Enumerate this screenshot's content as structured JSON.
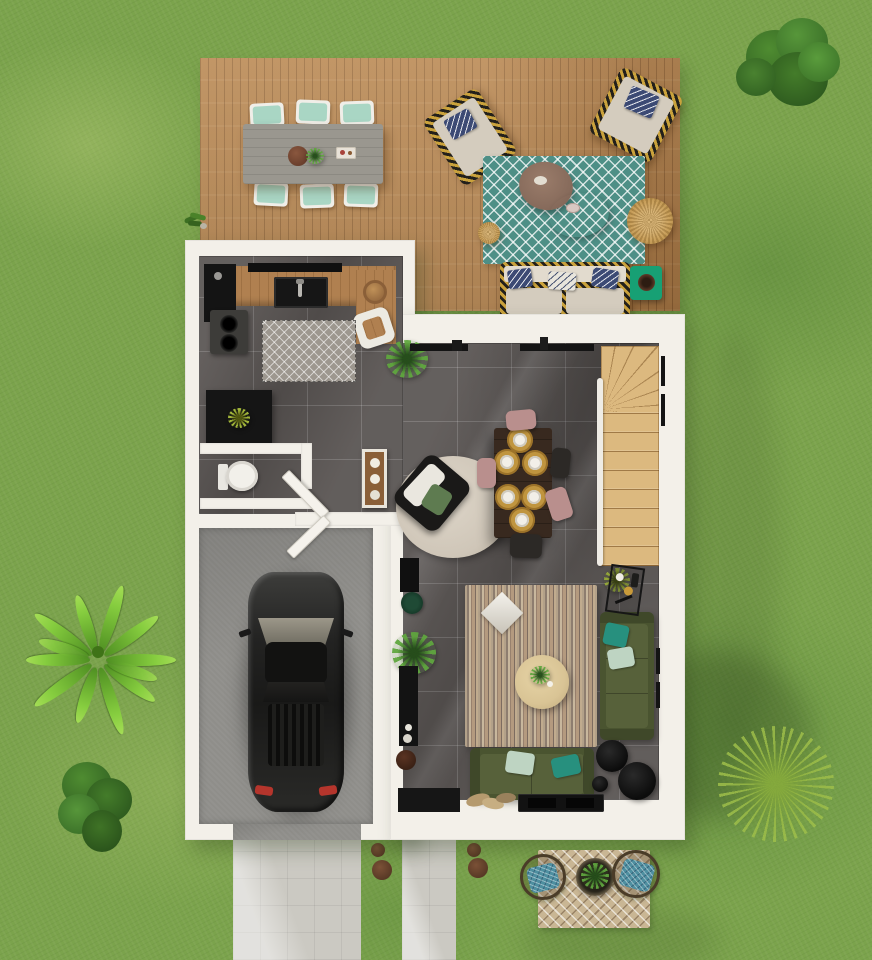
{
  "scene": {
    "description": "Top-down 3D architectural floor-plan render of a single-storey house with lawn, wooden terrace, garage, driveway and furnished interior",
    "view": "top-down",
    "canvas": {
      "width": 872,
      "height": 960
    }
  },
  "palette": {
    "grass": "#7ba34c",
    "deckWood": "#b5824c",
    "wall": "#f3f0e9",
    "tile": "#5c5755",
    "concrete": "#8f8e8a",
    "path": "#cbc9c2",
    "stairWood": "#dcb97f",
    "counterWood": "#b08050",
    "rugTeal": "#4e8f86",
    "sofaGreen": "#4a5430",
    "sofaGreenDark": "#57613a",
    "cushion": "#d4ccbe",
    "pillowNavy": "#3c4a74",
    "pillowMint": "#bed4c2",
    "pillowTeal": "#27907e",
    "outTableGray": "#9a978f",
    "seatMint": "#a9d6c4",
    "diningWood": "#38291f",
    "chairMauve": "#b98f8d",
    "chairDark": "#2c2926",
    "placemat": "#c0953f",
    "plate": "#f2efe8",
    "carBody": "#262624",
    "jute": "#c9a05c",
    "sideGreen": "#17a074",
    "rugRound": "#cfc6b8",
    "coffeeTable": "#d9c495",
    "bistroMat": "#c9b694",
    "bistroCushion": "#4e8fa0",
    "matGray": "#9d978f",
    "consoleWood": "#8a5f38",
    "stoneBrown": "#6b4630",
    "toilet": "#f2f0ea"
  },
  "outdoor": {
    "areas": [
      "lawn",
      "wooden-terrace",
      "driveway",
      "walkway"
    ],
    "terrace_items": [
      "outdoor-dining-table",
      "six-mint-chairs",
      "wicker-lounge-chair-west",
      "wicker-lounge-chair-north",
      "teal-chevron-rug",
      "two-coffee-tables",
      "jute-pouf-small",
      "jute-pouf-large",
      "outdoor-sofa",
      "green-side-table"
    ],
    "garden_items": [
      "palm-tree",
      "bush-top-right",
      "bush-bottom-left",
      "spiky-grass-plant",
      "bistro-set-with-planter",
      "stepping-stones",
      "grass-tuft"
    ]
  },
  "rooms": [
    {
      "id": "kitchen",
      "items": [
        "wood-counter",
        "sink",
        "cooktop",
        "black-cabinet",
        "coffee-machine",
        "kitchen-mat",
        "desk-chair",
        "round-stool",
        "plant-cabinet"
      ]
    },
    {
      "id": "wc",
      "items": [
        "toilet"
      ]
    },
    {
      "id": "entry-hall",
      "items": [
        "front-door",
        "console-table",
        "round-rug",
        "black-armchair"
      ]
    },
    {
      "id": "dining-area",
      "items": [
        "dining-table",
        "six-placemats",
        "five-chairs",
        "potted-palm"
      ]
    },
    {
      "id": "living-room",
      "items": [
        "striped-rug",
        "diamond-pillow",
        "round-coffee-table",
        "green-sofa-right",
        "green-sofa-bottom",
        "black-side-tables",
        "bar-cart",
        "tv-console",
        "media-units",
        "indoor-palm",
        "door-mat",
        "magazines"
      ]
    },
    {
      "id": "garage",
      "items": [
        "car",
        "garage-door"
      ]
    },
    {
      "id": "staircase",
      "items": [
        "winder-stairs",
        "railing",
        "side-door",
        "plant"
      ]
    }
  ]
}
